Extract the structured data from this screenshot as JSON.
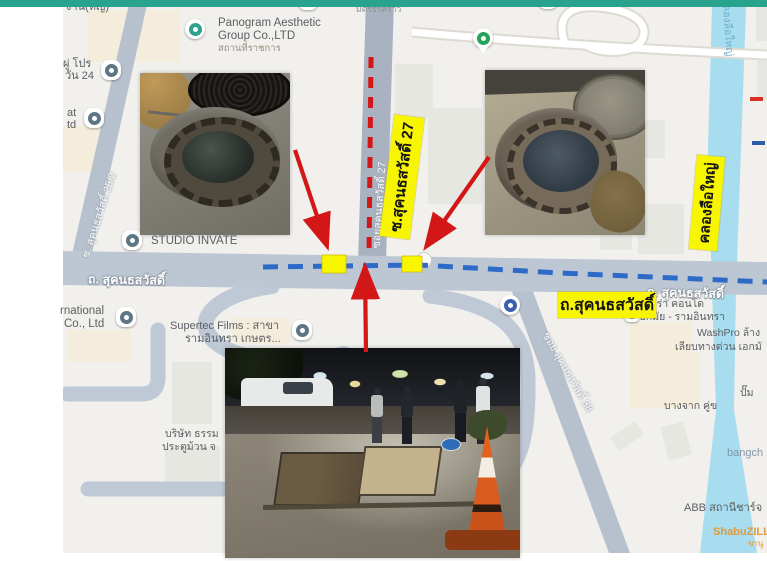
{
  "page": {
    "topbar_color": "#2aa38e"
  },
  "map": {
    "places": {
      "top_partial": "งาน(หญ่)",
      "top_small": "มิตรธิรคราว",
      "panogram1": "Panogram Aesthetic",
      "panogram2": "Group Co.,LTD",
      "panogram_sub": "สถานที่ราชการ",
      "pro1": "ผู่ โปร",
      "pro2": "วัน 24",
      "at1": "at",
      "at2": "td",
      "studio": "STUDIO INVATE",
      "rnational1": "rnational",
      "rnational2": "Co., Ltd",
      "supertec1": "Supertec Films : สาขา",
      "supertec2": "รามอินทรา เกษตร...",
      "borisat1": "บริษัท ธรรม",
      "borisat2": "ประตูม้วน จ",
      "nivera1": "นีเวร่า คอนโด",
      "nivera2": "เอกมัย - รามอินทรา",
      "washpro1": "WashPro ล้าง",
      "washpro2": "เลียบทางด่วน เอกมั",
      "pump1": "ปั๊ม",
      "pump2": "บางจาก คู่ข",
      "bangchak": "bangch",
      "abb": "ABB สถานีชาร์จ",
      "shabu1": "ShabuZILL",
      "shabu2": "ขานู"
    },
    "roads": {
      "main_left": "ถ. สุคนธสวัสดิ์",
      "main_right": "ถ. สุคนธสวัสดิ์",
      "soi25": "ซ. สุคนธสวัสดิ์ 25/2",
      "soi27": "ซอยสุคนธสวัสดิ์ 27",
      "soi38": "ซอย สุคนธสวัสดิ์ 38",
      "canal": "คลองลือใหญ่"
    }
  },
  "annotations": {
    "soi27_highlight": "ซ.สุคนธสวัสดิ์ 27",
    "road_highlight": "ถ.สุคนธสวัสดิ์",
    "canal_highlight": "คลองลือใหญ่",
    "highlight_bg": "#f8f500",
    "arrow_color": "#d31717",
    "blue_dash_color": "#2e6bc8"
  }
}
